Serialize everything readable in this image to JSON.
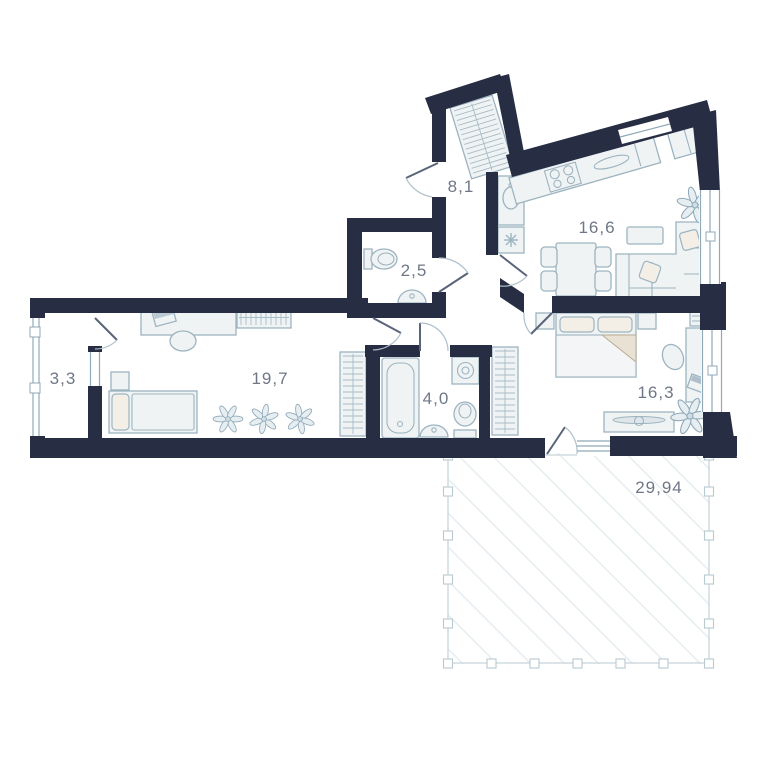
{
  "plan_type": "apartment floor plan",
  "colors": {
    "wall": "#272d42",
    "furniture_line": "#9db4c0",
    "label_text": "#6f7787",
    "terrace_hatch": "#e4ebee"
  },
  "areas": {
    "hallway": "8,1",
    "wc": "2,5",
    "kitchen_living": "16,6",
    "loggia": "3,3",
    "room": "19,7",
    "bathroom": "4,0",
    "bedroom": "16,3",
    "terrace": "29,94"
  }
}
